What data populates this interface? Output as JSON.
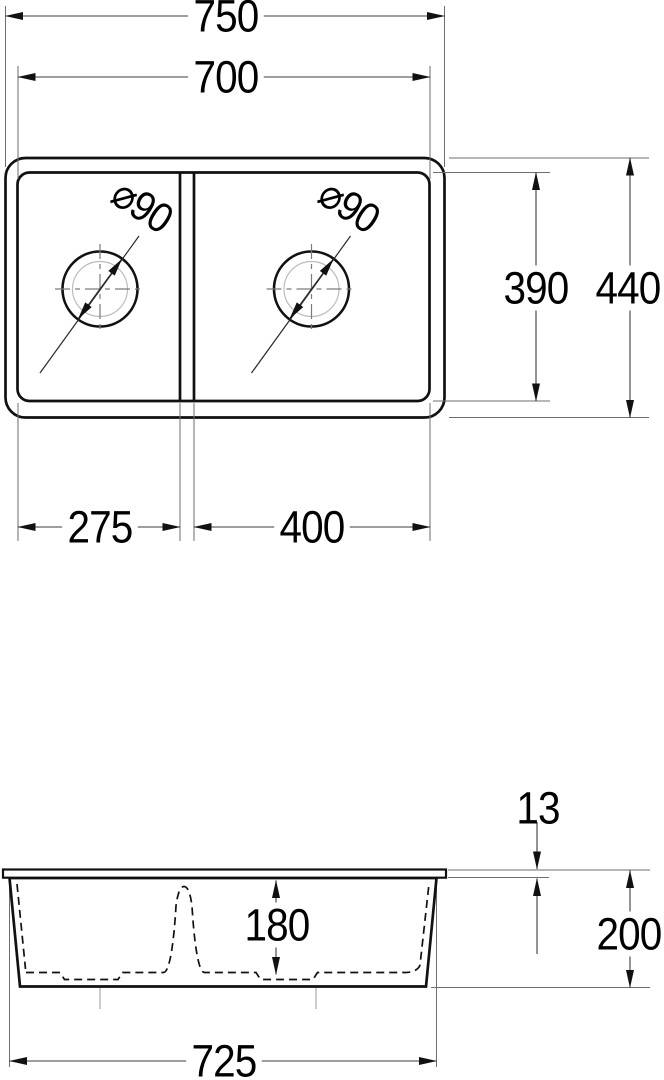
{
  "view_top": {
    "overall_width": "750",
    "inner_width": "700",
    "inner_depth": "390",
    "overall_depth": "440",
    "left_bowl_width": "275",
    "right_bowl_width": "400",
    "drain_left_diameter": "⌀90",
    "drain_right_diameter": "⌀90"
  },
  "view_side": {
    "rim_height": "13",
    "bowl_depth": "180",
    "overall_height": "200",
    "base_width": "725"
  },
  "colors": {
    "outline": "#111111",
    "dim_line": "#3c3c3c",
    "ext_line": "#6e6e6e",
    "light_circle": "#bcbcbc",
    "centerline": "#7a7a7a",
    "background": "#ffffff",
    "text": "#000000"
  }
}
